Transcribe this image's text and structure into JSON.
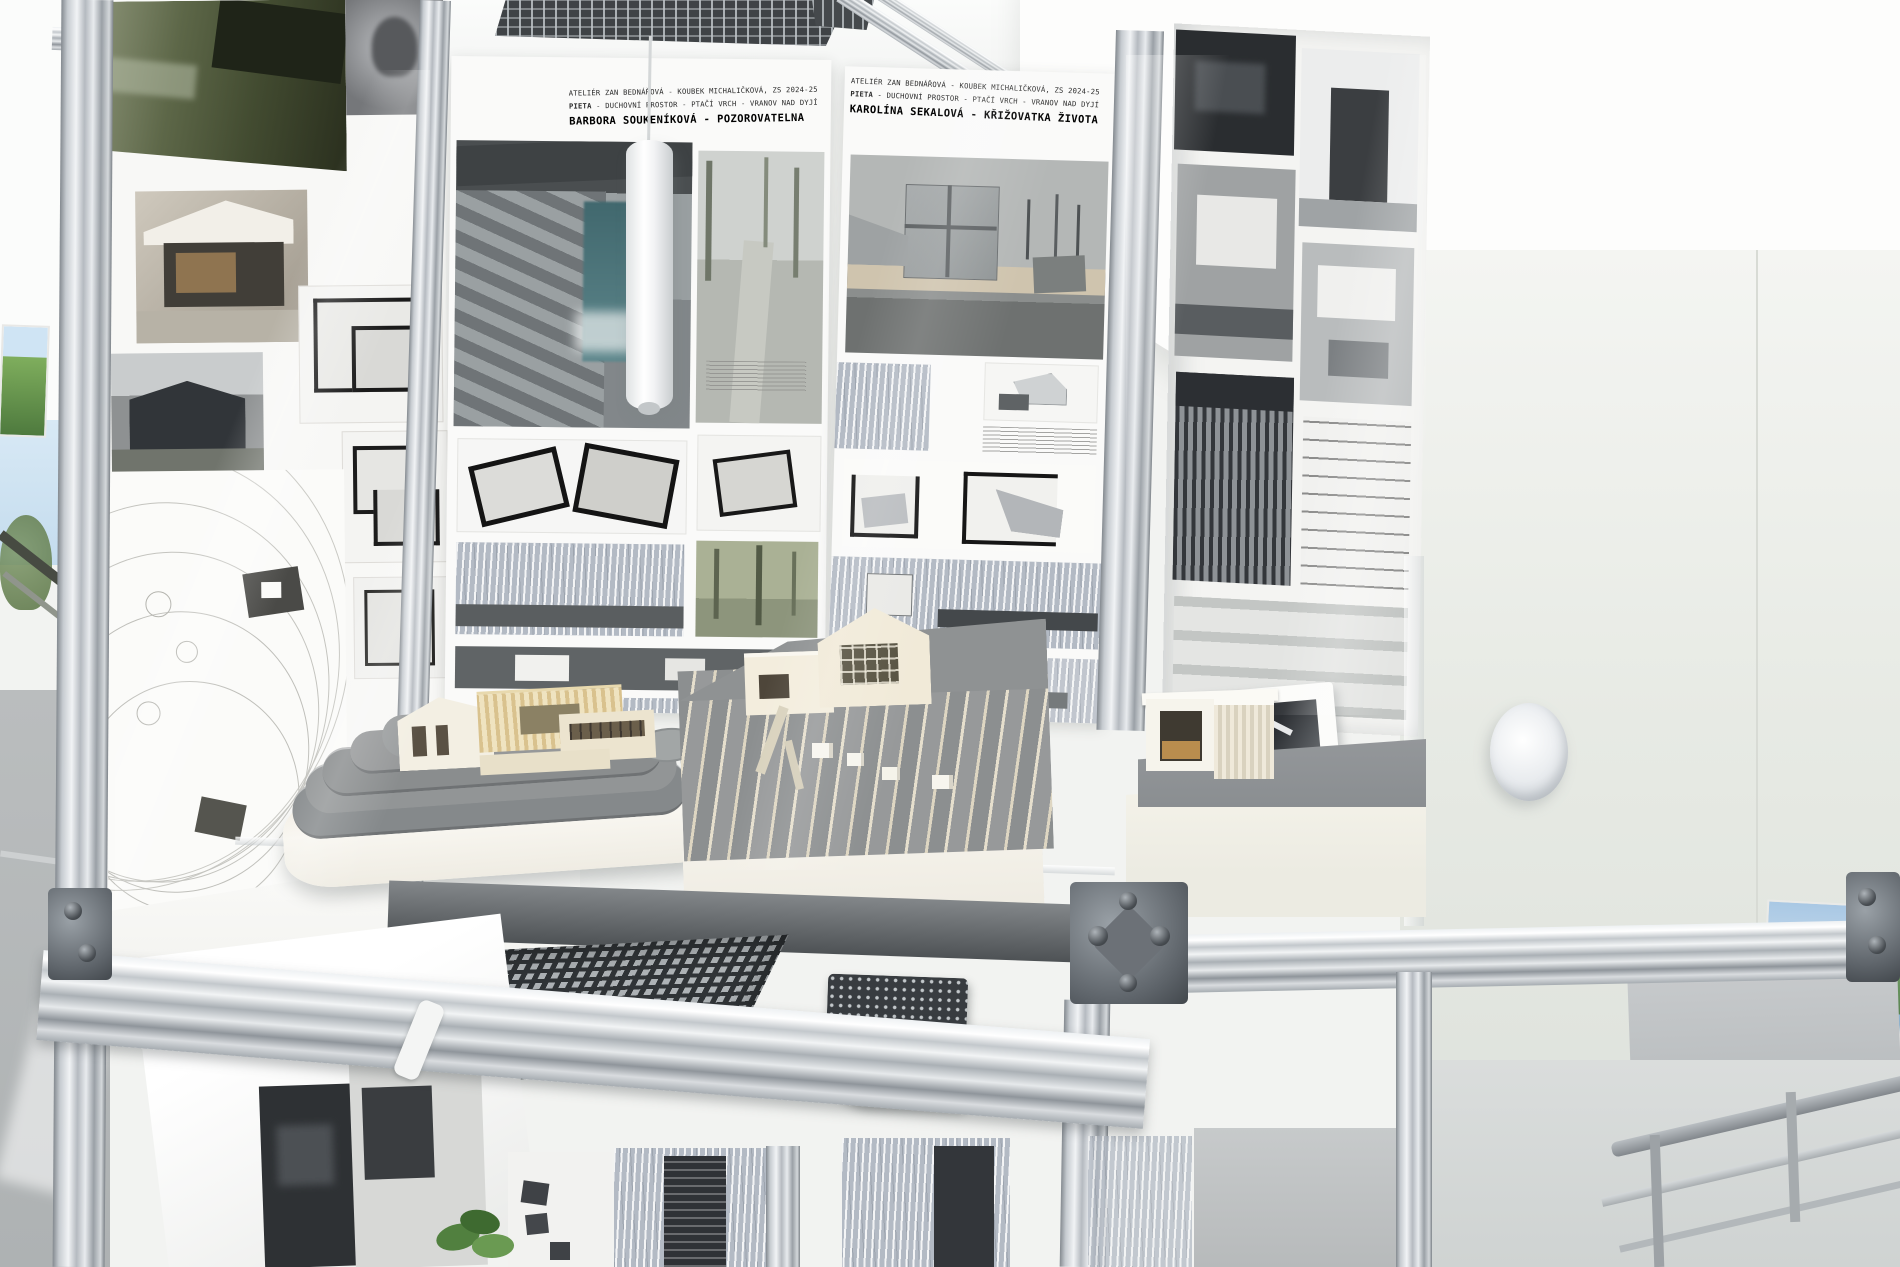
{
  "scene": {
    "setting": "Architecture school exhibition: aluminium display case with student posters and physical site models"
  },
  "posters": {
    "soukenikova": {
      "atelier_line": "ATELIÉR ZAN BEDNÁŘOVÁ - KOUBEK MICHALIČKOVÁ, ZS 2024-25",
      "theme_lead": "PIETA",
      "theme_rest": " - DUCHOVNÍ PROSTOR - PTAČÍ VRCH - VRANOV NAD DYJÍ",
      "author": "BARBORA SOUKENÍKOVÁ",
      "dash": " - ",
      "title": "POZOROVATELNA"
    },
    "sekalova": {
      "atelier_line": "ATELIÉR ZAN BEDNÁŘOVÁ - KOUBEK MICHALIČKOVÁ, ZS 2024-25",
      "theme_lead": "PIETA",
      "theme_rest": " - DUCHOVNÍ PROSTOR - PTAČÍ VRCH - VRANOV NAD DYJÍ",
      "author": "KAROLÍNA SEKALOVÁ",
      "dash": " - ",
      "title": "KŘIŽOVATKA ŽIVOTA"
    }
  },
  "model_base_label": {
    "line1": "ICHAL",
    "line2": "VRCH - V"
  },
  "colors": {
    "aluminum": "#c9ced3",
    "vent_grille": "#3f4346",
    "terrain_gray": "#8e9192",
    "model_cream": "#efe7d3",
    "waterfall_teal": "#41686e",
    "birch_collage": "#aab3bf",
    "wall": "#eceee9",
    "floor": "#b6babb"
  }
}
